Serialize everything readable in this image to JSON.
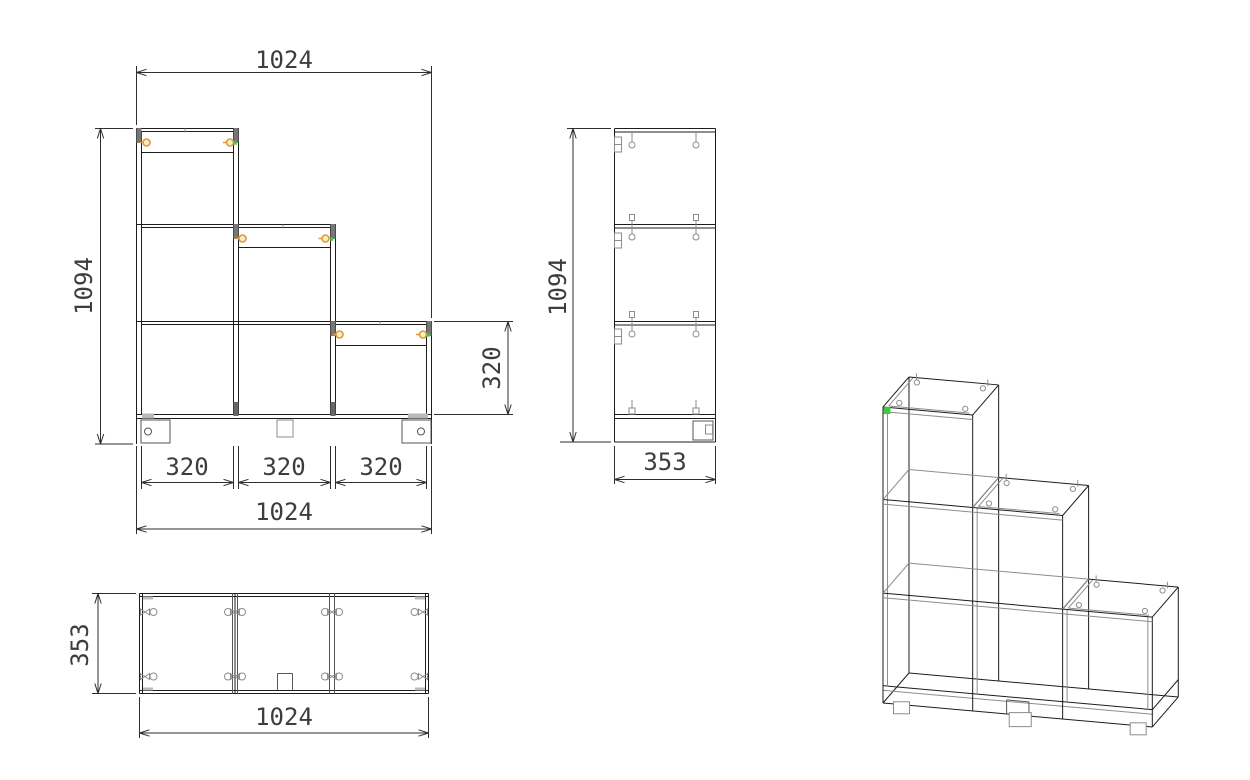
{
  "drawing": {
    "type": "furniture-technical-drawing",
    "subject": "staircase shelf unit, 3 columns (3/2/1 cells)",
    "views": {
      "front": {
        "name": "front view",
        "dims": {
          "width_top": "1024",
          "height": "1094",
          "cell_height": "320",
          "cell_width_1": "320",
          "cell_width_2": "320",
          "cell_width_3": "320",
          "width_bottom": "1024"
        }
      },
      "side": {
        "name": "side view",
        "dims": {
          "height": "1094",
          "depth": "353"
        }
      },
      "top": {
        "name": "top view",
        "dims": {
          "depth": "353",
          "width": "1024"
        }
      },
      "iso": {
        "name": "isometric view"
      }
    },
    "colors": {
      "background": "#ffffff",
      "line": "#1c1c1c",
      "detail": "#8d8d8d",
      "detail_dark": "#565656",
      "fastener_orange": "#dd9a33",
      "fastener_fill": "#faeccd",
      "marker_green": "#3ecb3e",
      "dim_line": "#2e2e2e",
      "dim_text": "#3d3d3d"
    }
  }
}
